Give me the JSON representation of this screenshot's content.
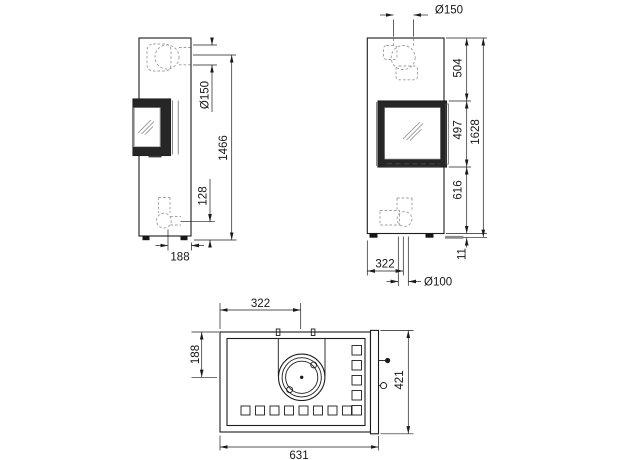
{
  "views": {
    "side": {
      "label": "side-view",
      "dims": {
        "flue_diameter": "Ø150",
        "flue_center_height": "1466",
        "air_inlet_height": "128",
        "air_inlet_rear_offset": "188"
      }
    },
    "front": {
      "label": "front-view",
      "dims": {
        "flue_diameter": "Ø150",
        "top_to_door": "504",
        "door_height": "497",
        "total_height": "1628",
        "door_to_base": "616",
        "foot_height": "11",
        "air_inlet_offset": "322",
        "air_inlet_diameter": "Ø100"
      }
    },
    "top": {
      "label": "top-view",
      "dims": {
        "flue_offset_left": "322",
        "flue_offset_rear": "188",
        "depth": "421",
        "width": "631"
      }
    }
  },
  "colors": {
    "line": "#1c1c1c",
    "dashed_pipe": "#9b9b9b",
    "door_frame": "#262626",
    "glass_hatch": "#8a8a8a",
    "floor_bar": "#8a8a8a",
    "background": "#ffffff"
  }
}
